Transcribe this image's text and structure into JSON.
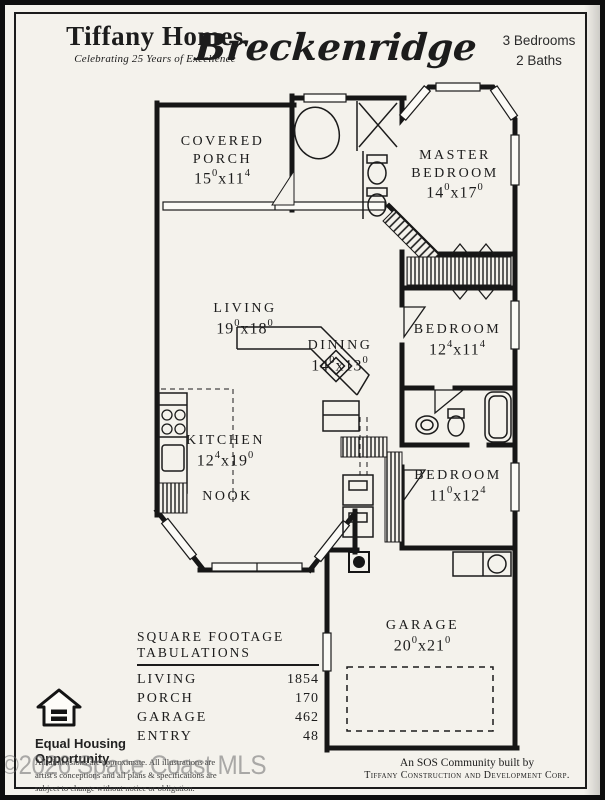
{
  "colors": {
    "paper": "#f4f2ec",
    "ink": "#1b1b1b",
    "watermark_gray": "#6d6d6d"
  },
  "header": {
    "company": "Tiffany Homes",
    "tagline": "Celebrating 25 Years of Excellence",
    "plan_name": "Breckenridge",
    "bedrooms": "3 Bedrooms",
    "baths": "2 Baths"
  },
  "rooms": [
    {
      "name": "COVERED PORCH",
      "w": "15",
      "wsup": "0",
      "sep": "x",
      "h": "11",
      "hsup": "4"
    },
    {
      "name": "MASTER BEDROOM",
      "w": "14",
      "wsup": "0",
      "sep": "x",
      "h": "17",
      "hsup": "0"
    },
    {
      "name": "LIVING",
      "w": "19",
      "wsup": "0",
      "sep": "x",
      "h": "18",
      "hsup": "0"
    },
    {
      "name": "DINING",
      "w": "14",
      "wsup": "0",
      "sep": "x",
      "h": "13",
      "hsup": "0"
    },
    {
      "name": "BEDROOM",
      "w": "12",
      "wsup": "4",
      "sep": "x",
      "h": "11",
      "hsup": "4"
    },
    {
      "name": "KITCHEN",
      "w": "12",
      "wsup": "4",
      "sep": "x",
      "h": "19",
      "hsup": "0"
    },
    {
      "name": "NOOK"
    },
    {
      "name": "BEDROOM",
      "w": "11",
      "wsup": "0",
      "sep": "x",
      "h": "12",
      "hsup": "4"
    },
    {
      "name": "GARAGE",
      "w": "20",
      "wsup": "0",
      "sep": "x",
      "h": "21",
      "hsup": "0"
    }
  ],
  "footage": {
    "title_line1": "SQUARE FOOTAGE",
    "title_line2": "TABULATIONS",
    "rows": [
      {
        "label": "LIVING",
        "value": "1854"
      },
      {
        "label": "PORCH",
        "value": "170"
      },
      {
        "label": "GARAGE",
        "value": "462"
      },
      {
        "label": "ENTRY",
        "value": "48"
      }
    ]
  },
  "equal_housing": {
    "line1": "Equal Housing",
    "line2": "Opportunity"
  },
  "disclaimer": {
    "line1": "All dimensions are approximate.  All illustrations are",
    "line2": "artist's conceptions and all plans & specifications are",
    "line3": "subject to change without notice or obligation."
  },
  "builder": {
    "line1": "An SOS Community built by",
    "line2": "Tiffany Construction and Development Corp."
  },
  "watermark": "©2026 Space Coast MLS"
}
